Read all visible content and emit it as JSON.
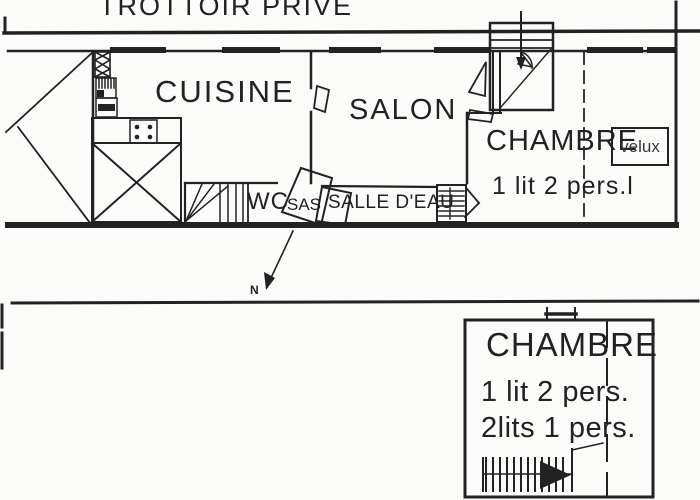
{
  "colors": {
    "ink": "#222222",
    "paper": "#fbfbfa"
  },
  "upper_plan": {
    "street_label": "TROTTOIR PRIVE",
    "rooms": {
      "cuisine": "CUISINE",
      "salon": "SALON",
      "chambre": "CHAMBRE",
      "wc": "WC",
      "sas": "SAS",
      "salle_eau": "SALLE D'EAU"
    },
    "annotations": {
      "velux": "velux",
      "beds": "1 lit 2 pers.l"
    }
  },
  "north_label": "N",
  "lower_plan": {
    "chambre": "CHAMBRE",
    "beds_line1": "1 lit 2 pers.",
    "beds_line2": "2lits 1 pers."
  }
}
